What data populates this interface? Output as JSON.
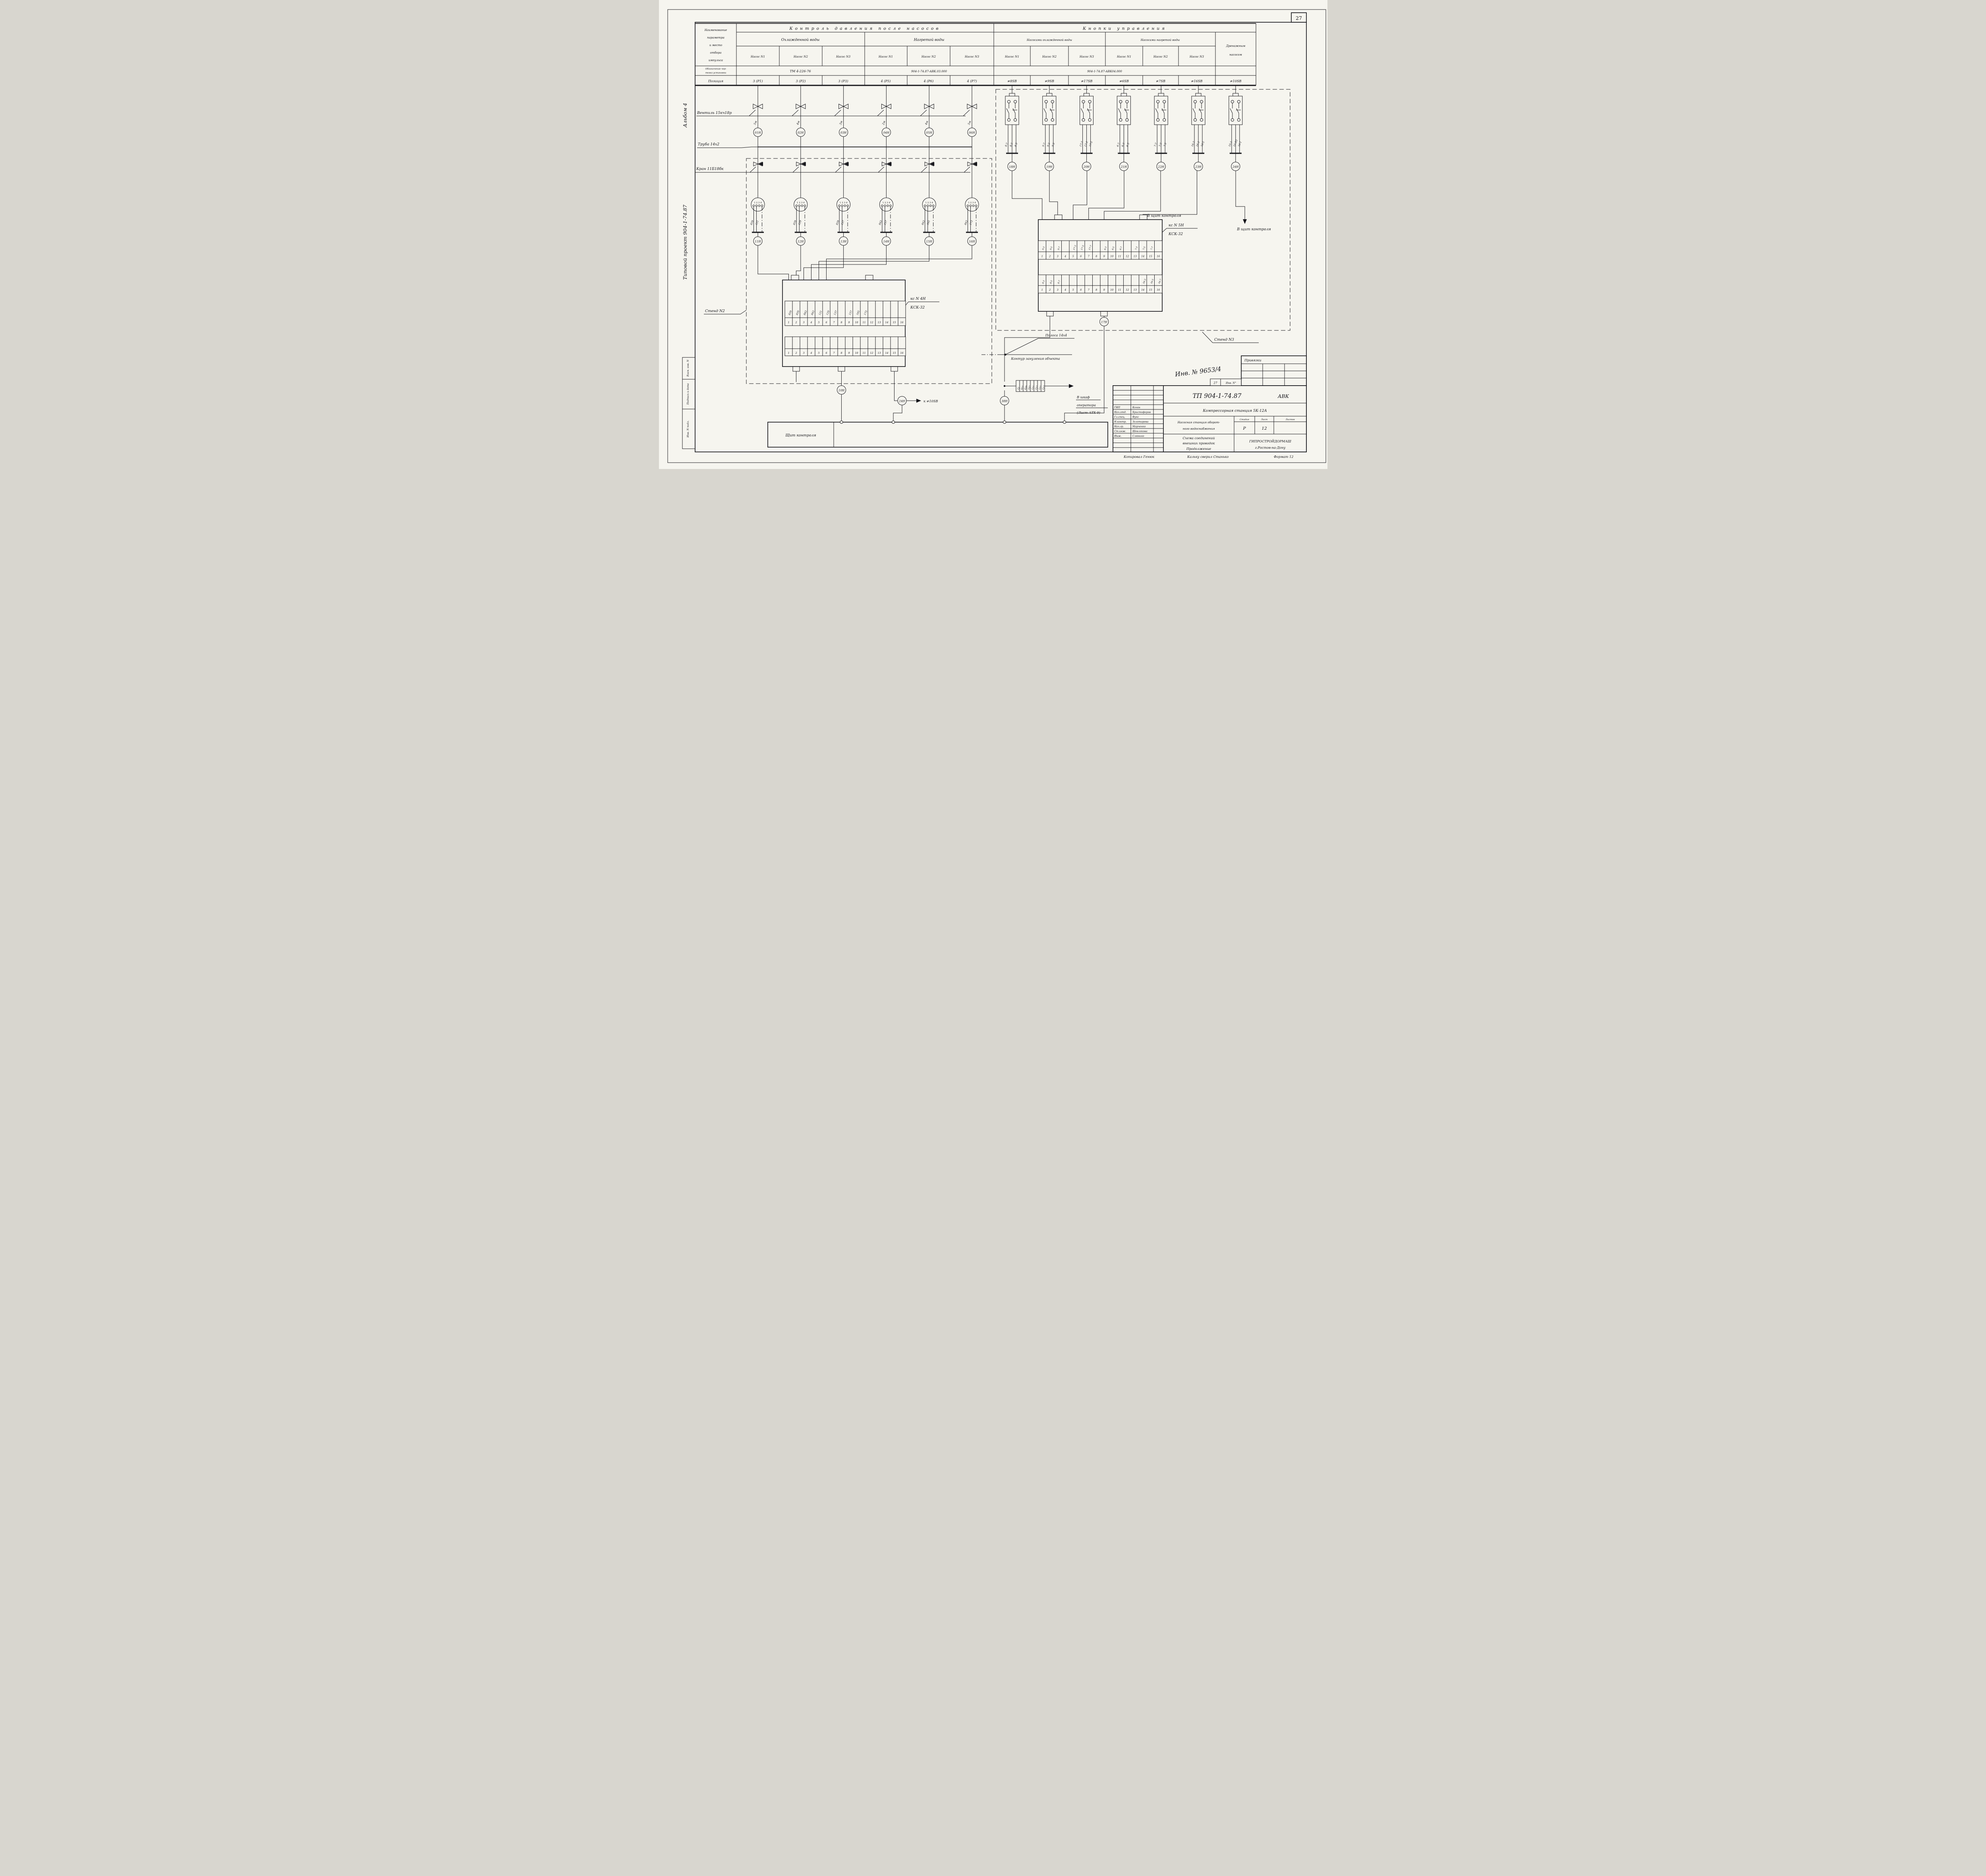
{
  "page": {
    "number": "27"
  },
  "sidebar": {
    "album": "Альбом 4",
    "project": "Типовой проект 904-1-74.87",
    "stamp_boxes": [
      "Взам. инв. N",
      "Подпись и дата",
      "Инв. N подл."
    ]
  },
  "table": {
    "param_header_lines": [
      "Наименование",
      "параметра",
      "и место",
      "отбора",
      "импульса"
    ],
    "drawing_row_header_lines": [
      "Обозначение чер-",
      "тежа установки"
    ],
    "position_row_header": "Позиция",
    "group_left_title": "Контроль давления после насосов",
    "group_right_title": "Кнопки управления",
    "sub_cooled": "Охлажденной воды",
    "sub_heated": "Нагретой воды",
    "sub_pumps_cooled": "Насосами охлажденной воды",
    "sub_pumps_heated": "Насосами нагретой воды",
    "drain_lines": [
      "Дренажным",
      "насосом"
    ],
    "pump_cols": [
      "Насос N1",
      "Насос N2",
      "Насос N3",
      "Насос N1",
      "Насос N2",
      "Насос N3",
      "Насос N1",
      "Насос N2",
      "Насос N3",
      "Насос N1",
      "Насос N2",
      "Насос N3"
    ],
    "drawing_refs": [
      "ТМ 4-226-76",
      "904-1-74.87-АВК.03.000",
      "904-1-74.87-АВК04.000"
    ],
    "positions": [
      "3 (Р1)",
      "3 (Р2)",
      "3 (Р3)",
      "4 (Р5)",
      "4 (Р6)",
      "4 (Р7)",
      "≠8SB",
      "≠9SB",
      "≠17SB",
      "≠6SB",
      "≠7SB",
      "≠16SB",
      "≠10SB"
    ]
  },
  "left_section": {
    "valve_label": "Вентиль 15кч18р",
    "pipe_label": "Труба 14х2",
    "tap_label": "Кран 11Б18бк",
    "stand_label": "Стенд N2",
    "pins_label": "1 2 3 4",
    "columns": [
      {
        "len": "5м",
        "g": "01Н",
        "a": "839",
        "b": "121",
        "c": "11Н"
      },
      {
        "len": "4м",
        "g": "02Н",
        "a": "839",
        "b": "129",
        "c": "12Н"
      },
      {
        "len": "3м",
        "g": "03Н",
        "a": "839",
        "b": "137",
        "c": "13Н"
      },
      {
        "len": "2м",
        "g": "04Н",
        "a": "843",
        "b": "157",
        "c": "14Н"
      },
      {
        "len": "4м",
        "g": "05Н",
        "a": "843",
        "b": "165",
        "c": "15Н"
      },
      {
        "len": "5м",
        "g": "06Н",
        "a": "843",
        "b": "173",
        "c": "16Н"
      }
    ],
    "ksn": "кс N 4Н",
    "ksk": "КСК-32",
    "strip1": [
      {
        "t": "839",
        "n": "1"
      },
      {
        "t": "839",
        "n": "2"
      },
      {
        "t": "843",
        "n": "3"
      },
      {
        "t": "843",
        "n": "4"
      },
      {
        "t": "121",
        "n": "5"
      },
      {
        "t": "129",
        "n": "6"
      },
      {
        "t": "137",
        "n": "7"
      },
      {
        "t": "",
        "n": "8"
      },
      {
        "t": "157",
        "n": "9"
      },
      {
        "t": "165",
        "n": "10"
      },
      {
        "t": "173",
        "n": "11"
      },
      {
        "t": "",
        "n": "12"
      },
      {
        "t": "",
        "n": "13"
      },
      {
        "t": "",
        "n": "14"
      },
      {
        "t": "",
        "n": "15"
      },
      {
        "t": "",
        "n": "16"
      }
    ],
    "strip2": [
      {
        "n": "1"
      },
      {
        "n": "2"
      },
      {
        "n": "3"
      },
      {
        "n": "4"
      },
      {
        "n": "5"
      },
      {
        "n": "6"
      },
      {
        "n": "7"
      },
      {
        "n": "8"
      },
      {
        "n": "9"
      },
      {
        "n": "10"
      },
      {
        "n": "11"
      },
      {
        "n": "12"
      },
      {
        "n": "13"
      },
      {
        "n": "14"
      },
      {
        "n": "15"
      },
      {
        "n": "16"
      }
    ],
    "gauge10": "10Н",
    "conn24": "24Н",
    "to_sb": "к ≠10SB",
    "shield": "Щит контроля",
    "strip_label": "Полоса 14х4",
    "ground_label": "Контур зануления объекта"
  },
  "right_section": {
    "stand_label": "Стенд N3",
    "to_shield": "В щит контроля",
    "buttons": [
      {
        "t1": "8-7",
        "t2": "8-3",
        "t3": "8-5",
        "c": "18Н"
      },
      {
        "t1": "9-7",
        "t2": "9-3",
        "t3": "9-5",
        "c": "19Н"
      },
      {
        "t1": "17-7",
        "t2": "17-3",
        "t3": "17-5",
        "c": "20Н"
      },
      {
        "t1": "6-7",
        "t2": "6-3",
        "t3": "6-5",
        "c": "21Н"
      },
      {
        "t1": "7-7",
        "t2": "7-3",
        "t3": "7-5",
        "c": "22Н"
      },
      {
        "t1": "16-7",
        "t2": "16-3",
        "t3": "16-5",
        "c": "23Н"
      },
      {
        "t1": "10-3",
        "t2": "10-П1",
        "t3": "10-1",
        "c": "24Н"
      }
    ],
    "ksn": "кс N 5Н",
    "ksk": "КСК-32",
    "strip1": [
      {
        "t": "9-3",
        "n": "1"
      },
      {
        "t": "9-5",
        "n": "2"
      },
      {
        "t": "9-7",
        "n": "3"
      },
      {
        "t": "",
        "n": "4"
      },
      {
        "t": "17-3",
        "n": "5"
      },
      {
        "t": "17-5",
        "n": "6"
      },
      {
        "t": "17-7",
        "n": "7"
      },
      {
        "t": "",
        "n": "8"
      },
      {
        "t": "6-3",
        "n": "9"
      },
      {
        "t": "6-5",
        "n": "10"
      },
      {
        "t": "6-7",
        "n": "11"
      },
      {
        "t": "",
        "n": "12"
      },
      {
        "t": "7-3",
        "n": "13"
      },
      {
        "t": "7-5",
        "n": "14"
      },
      {
        "t": "7-7",
        "n": "15"
      },
      {
        "t": "",
        "n": "16"
      }
    ],
    "strip2": [
      {
        "t": "8-3",
        "n": "1"
      },
      {
        "t": "8-5",
        "n": "2"
      },
      {
        "t": "8-7",
        "n": "3"
      },
      {
        "t": "",
        "n": "4"
      },
      {
        "t": "",
        "n": "5"
      },
      {
        "t": "",
        "n": "6"
      },
      {
        "t": "",
        "n": "7"
      },
      {
        "t": "",
        "n": "8"
      },
      {
        "t": "",
        "n": "9"
      },
      {
        "t": "",
        "n": "10"
      },
      {
        "t": "",
        "n": "11"
      },
      {
        "t": "",
        "n": "12"
      },
      {
        "t": "",
        "n": "13"
      },
      {
        "t": "16-3",
        "n": "14"
      },
      {
        "t": "16-5",
        "n": "15"
      },
      {
        "t": "16-7",
        "n": "16"
      }
    ],
    "gauge17": "17Н",
    "gauge38": "38Н",
    "cable_block": [
      "22",
      "811",
      "839",
      "107",
      "111",
      "113",
      "115",
      "117"
    ],
    "to_cabinet_1": "В шкаф",
    "to_cabinet_2": "оператора",
    "to_cabinet_3": "(Лист АТХ-9)"
  },
  "title_block": {
    "doc": "ТП 904-1-74.87",
    "mark": "АВК",
    "station": "Компрессорная станция 5К-12А",
    "object_1": "Насосная станция оборот-",
    "object_2": "ного водоснабжения",
    "stage_h": "Стадия",
    "sheet_h": "Лист",
    "sheets_h": "Листов",
    "stage": "Р",
    "sheet": "12",
    "scheme_1": "Схема соединений",
    "scheme_2": "внешних проводок",
    "scheme_3": "Продолжение",
    "org": "ГИПРОСТРОЙДОРМАШ",
    "org_city": "г.Ростов-на-Дону",
    "roles": [
      {
        "role": "ГИП",
        "name": "Коган"
      },
      {
        "role": "Нач.отд.",
        "name": "Христофоров"
      },
      {
        "role": "Гл.спец.",
        "name": "Фукс"
      },
      {
        "role": "Н.контр.",
        "name": "Золотарева"
      },
      {
        "role": "Нач.гр.",
        "name": "Марченко"
      },
      {
        "role": "Ст.инж.",
        "name": "Шевлякова"
      },
      {
        "role": "Инж.",
        "name": "Слюнько"
      }
    ],
    "inv_big": "Инв. № 9653/4",
    "privyazki": "Привязки",
    "small_page": "27",
    "small_inv": "Инв. N°",
    "copied": "Копировал Генюк",
    "checked": "Кальку сверил Станько",
    "format": "Формат 12"
  }
}
